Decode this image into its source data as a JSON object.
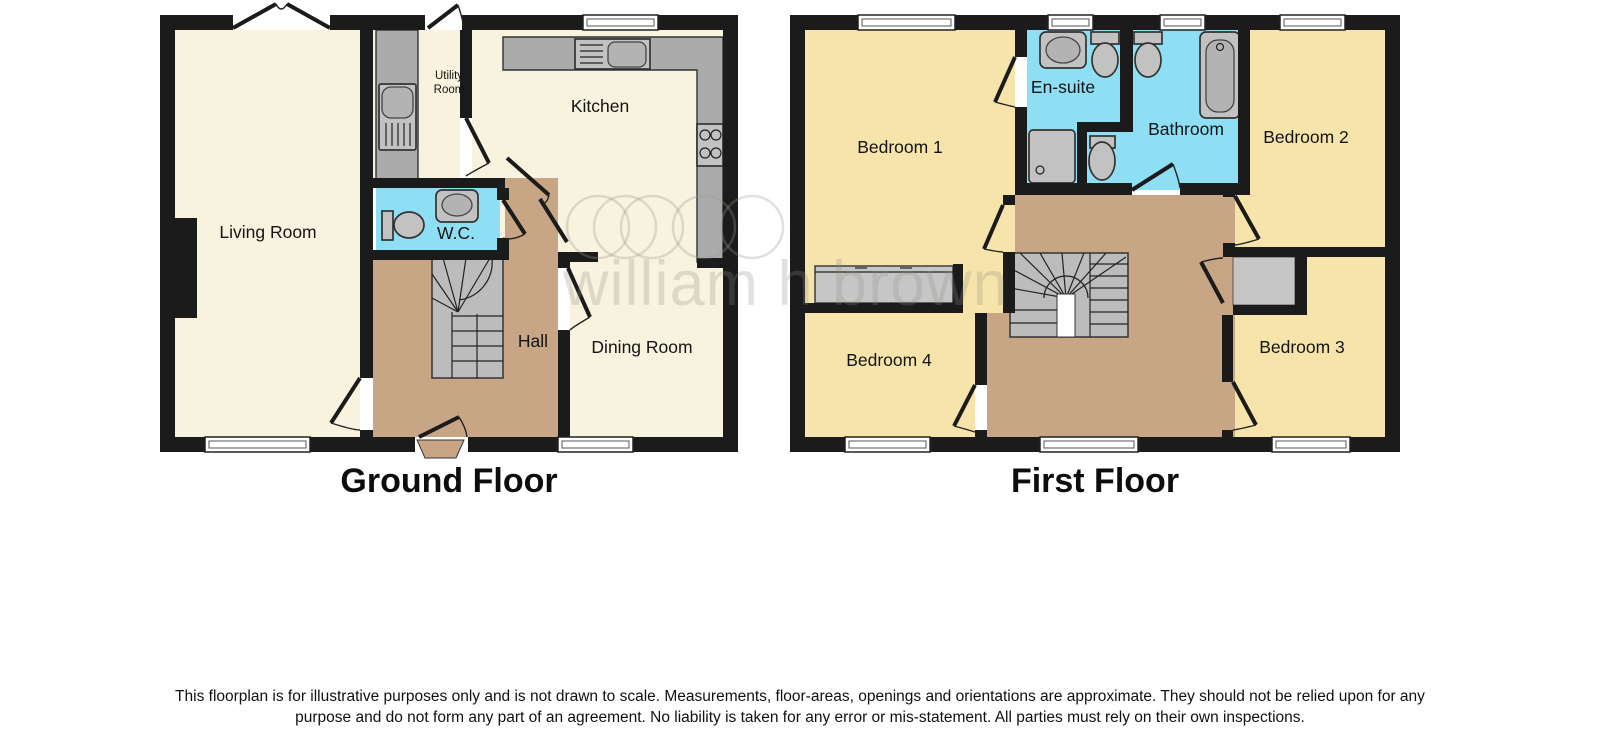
{
  "ground_floor": {
    "title": "Ground Floor",
    "rooms": {
      "living_room": "Living Room",
      "utility_line1": "Utility",
      "utility_line2": "Room",
      "kitchen": "Kitchen",
      "wc": "W.C.",
      "hall": "Hall",
      "dining_room": "Dining Room"
    }
  },
  "first_floor": {
    "title": "First Floor",
    "rooms": {
      "bedroom1": "Bedroom 1",
      "ensuite": "En-suite",
      "bathroom": "Bathroom",
      "bedroom2": "Bedroom 2",
      "bedroom3": "Bedroom 3",
      "bedroom4": "Bedroom 4"
    }
  },
  "watermark": {
    "text": "william h brown"
  },
  "disclaimer": {
    "line1": "This floorplan is for illustrative purposes only and is not drawn to scale. Measurements, floor-areas, openings and orientations are approximate. They should not be relied upon for any",
    "line2": "purpose and do not form any part of an agreement. No liability is taken for any error or mis-statement. All parties must rely on their own inspections."
  },
  "colors": {
    "wall": "#1b1b1b",
    "room_cream": "#f8f3de",
    "room_yellow": "#f6e4aa",
    "room_tan": "#c7a585",
    "room_cyan": "#8edff3",
    "counter_grey": "#ababab",
    "fixture_grey": "#c2c2c2",
    "wardrobe_grey": "#c6c6c6"
  }
}
